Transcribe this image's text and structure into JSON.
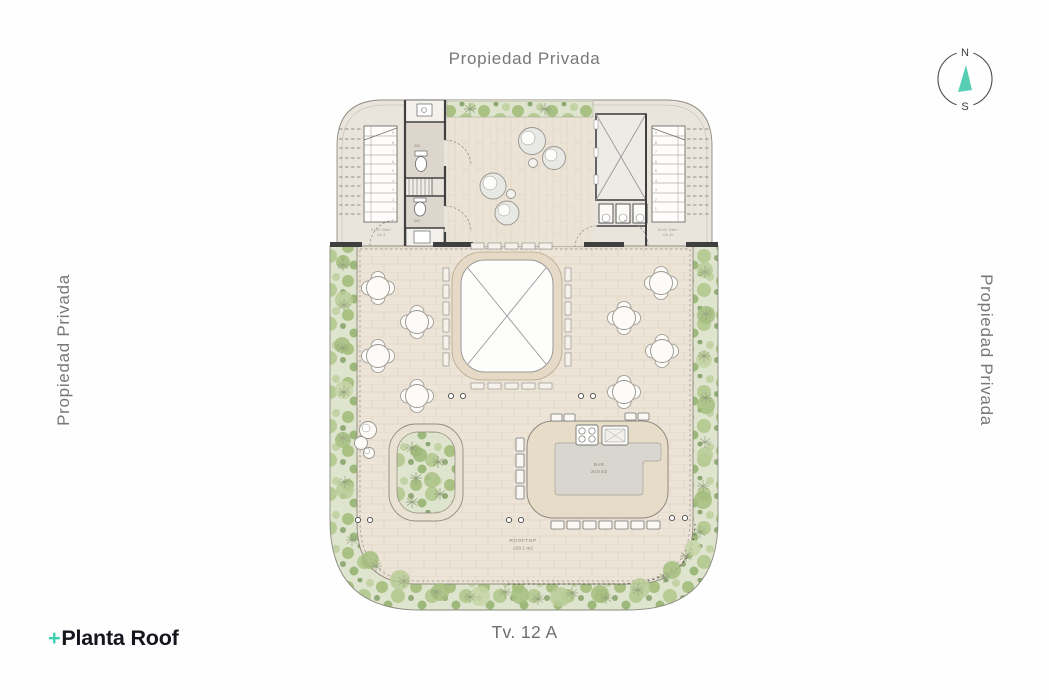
{
  "labels": {
    "top": "Propiedad Privada",
    "left": "Propiedad Privada",
    "right": "Propiedad Privada",
    "street": "Tv. 12 A"
  },
  "logo": {
    "plus": "+",
    "name": "Planta Roof",
    "accent_color": "#3ed0ae",
    "text_color": "#15151d"
  },
  "compass": {
    "north": "N",
    "south": "S",
    "needle_color": "#57cfb4"
  },
  "plan": {
    "bar": {
      "name": "BAR",
      "area": "20.9 m2"
    },
    "rooftop": {
      "name": "ROOFTOP",
      "area": "228.1 m2"
    },
    "wc_upper": "WC",
    "wc_lower": "WC",
    "stair_left": {
      "note1": "S.U.E. 3.9m+",
      "note2": "CA .2",
      "treads": [
        "9",
        "8",
        "7",
        "6",
        "5",
        "4",
        "3",
        "2",
        "1"
      ]
    },
    "stair_right": {
      "note1": "S.U.E. 3.9m+",
      "note2": "CA .11"
    },
    "colors": {
      "terrace_floor": "#ece4d6",
      "upper_band_floor": "#e9e4dc",
      "greenery_base": "#dfe5cf",
      "greenery_bush": "#a9c183",
      "wall": "#3f3f3f",
      "skylight_ring": "#e6dac6",
      "bar_counter": "#e7dcc8",
      "bar_floor": "#d9d6cf"
    }
  }
}
